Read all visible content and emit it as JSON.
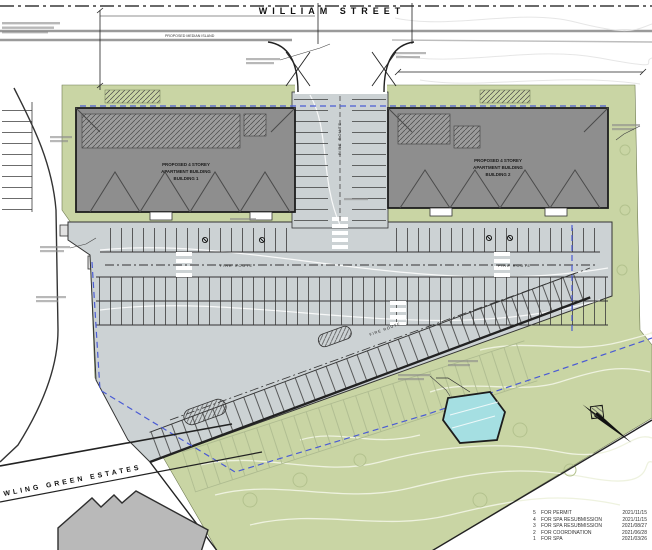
{
  "streets": {
    "william": "WILLIAM STREET",
    "bowling": "WLING GREEN ESTATES"
  },
  "buildings": {
    "b1": {
      "l1": "PROPOSED 4 STOREY",
      "l2": "APARTMENT BUILDING",
      "l3": "BUILDING 1"
    },
    "b2": {
      "l1": "PROPOSED 4 STOREY",
      "l2": "APARTMENT BUILDING",
      "l3": "BUILDING 2"
    }
  },
  "annotations": {
    "fire_route": "FIRE ROUTE",
    "median": "PROPOSED MEDIAN ISLAND"
  },
  "revisions": [
    {
      "no": "5",
      "desc": "FOR PERMIT",
      "date": "2021/11/15"
    },
    {
      "no": "4",
      "desc": "FOR SPA RESUBMISSION",
      "date": "2021/11/15"
    },
    {
      "no": "3",
      "desc": "FOR SPA RESUBMISSION",
      "date": "2021/08/27"
    },
    {
      "no": "2",
      "desc": "FOR COORDINATION",
      "date": "2021/06/28"
    },
    {
      "no": "1",
      "desc": "FOR SPA",
      "date": "2021/03/26"
    }
  ],
  "colors": {
    "green": "#c9d5a4",
    "asphalt": "#ccd2d4",
    "building": "#8e8e8e",
    "pond": "#a5dfe2",
    "property_line": "#4a5bd4"
  }
}
